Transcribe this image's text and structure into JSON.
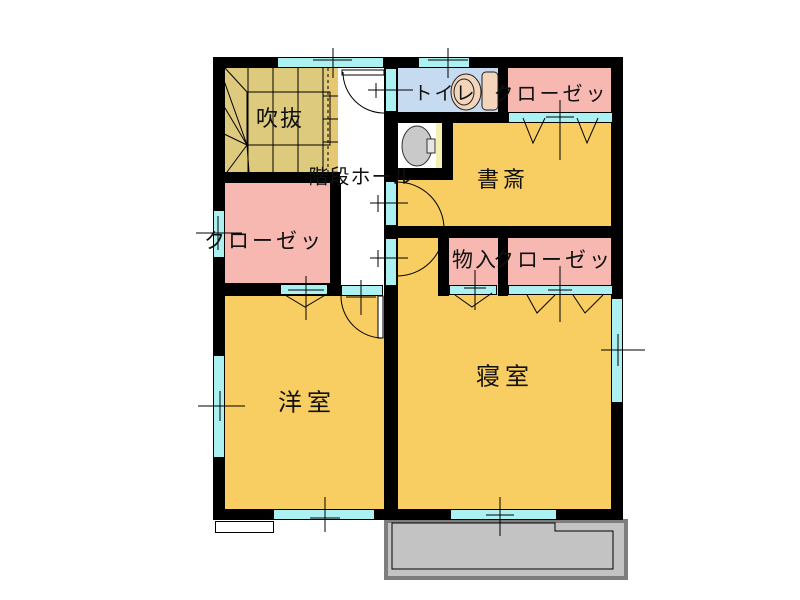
{
  "labels": {
    "void": "吹抜",
    "toilet": "トイレ",
    "closet_top": "クローゼッ",
    "study": "書斎",
    "stair_hall": "階段ホール",
    "closet_left": "クローゼッ",
    "storage": "物入",
    "closet_mid": "クローゼッ",
    "western_room": "洋室",
    "bedroom": "寝室"
  },
  "icons": {
    "toilet_fixture": "toilet-plan-symbol",
    "washbasin": "washbasin-plan-symbol",
    "stairs": "winder-staircase-symbol",
    "bifold_door": "folding-door-v-symbol",
    "swing_door": "door-arc-symbol"
  },
  "colors": {
    "wall": "#000000",
    "room_yellow": "#f8cd62",
    "stair_tan": "#ddca7c",
    "stair_strip": "#e6c873",
    "closet_pink": "#f6b8b1",
    "toilet_blue": "#c6daf0",
    "window_cyan": "#abf1f2",
    "balcony_fill": "#c3c3c3",
    "balcony_border": "#7e7e7e",
    "counter_yellow": "#f4f0b4",
    "fixture_tan": "#f2d5ba",
    "basin_gray": "#c9c9c9"
  }
}
